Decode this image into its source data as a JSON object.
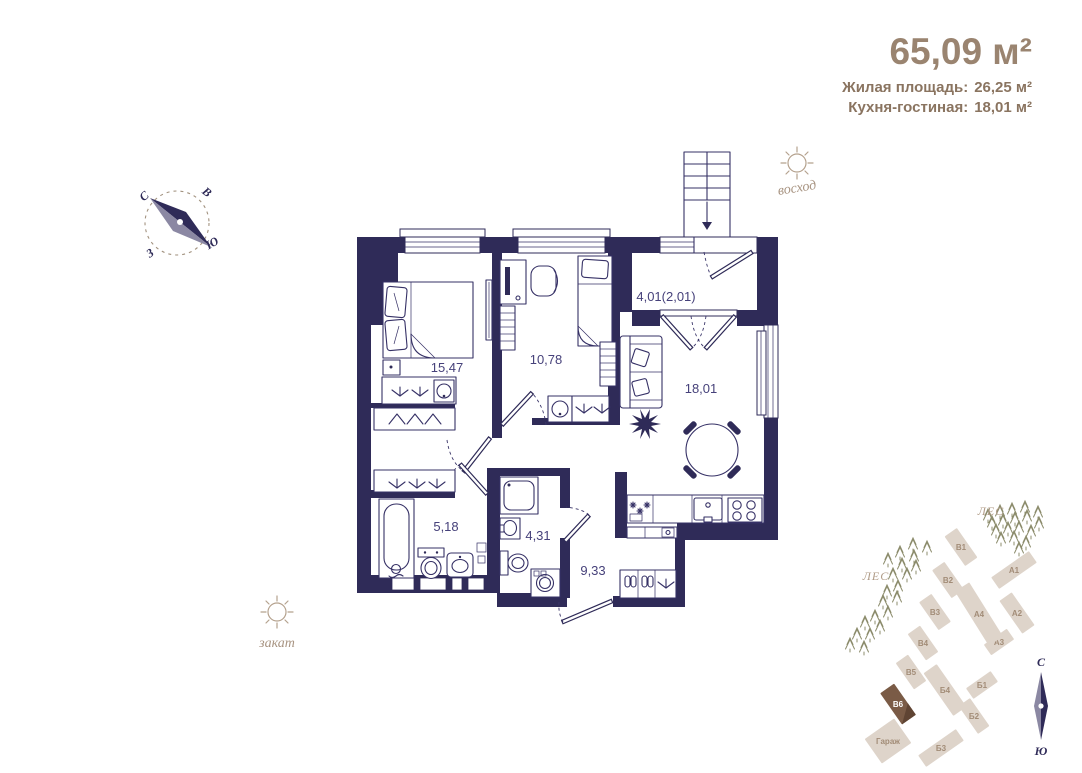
{
  "header": {
    "total_area": "65,09 м²",
    "living": {
      "label": "Жилая площадь:",
      "value": "26,25 м²"
    },
    "kitchen": {
      "label": "Кухня-гостиная:",
      "value": "18,01 м²"
    }
  },
  "orientation": {
    "sunrise": "восход",
    "sunset": "закат",
    "compass": {
      "n": "С",
      "e": "В",
      "s": "Ю",
      "w": "З"
    }
  },
  "rooms": {
    "bedroom": "15,47",
    "child": "10,78",
    "balcony": "4,01(2,01)",
    "living": "18,01",
    "bath": "5,18",
    "wc": "4,31",
    "hall": "9,33"
  },
  "site_plan": {
    "forest1": "ЛЕС",
    "forest2": "ЛЕС",
    "compass": {
      "n": "С",
      "s": "Ю"
    },
    "colors": {
      "building": "#ded4ca",
      "building_label": "#a28c77",
      "selected": "#7a5b46",
      "selected_dark": "#5f4433",
      "selected_label": "#ffffff",
      "tree": "#8c8c6c"
    },
    "buildings": [
      {
        "label": "В1",
        "cx": 961,
        "cy": 547,
        "w": 15,
        "h": 36,
        "rot": -35
      },
      {
        "label": "В2",
        "cx": 948,
        "cy": 580,
        "w": 15,
        "h": 34,
        "rot": -35
      },
      {
        "label": "В3",
        "cx": 935,
        "cy": 612,
        "w": 15,
        "h": 34,
        "rot": -35
      },
      {
        "label": "В4",
        "cx": 923,
        "cy": 643,
        "w": 15,
        "h": 32,
        "rot": -35
      },
      {
        "label": "В5",
        "cx": 911,
        "cy": 672,
        "w": 15,
        "h": 32,
        "rot": -35
      },
      {
        "label": "В6",
        "cx": 898,
        "cy": 704,
        "w": 17,
        "h": 38,
        "rot": -35,
        "selected": true
      },
      {
        "label": "А1",
        "cx": 1014,
        "cy": 570,
        "w": 14,
        "h": 46,
        "rot": 55
      },
      {
        "label": "А2",
        "cx": 1017,
        "cy": 613,
        "w": 15,
        "h": 40,
        "rot": -35
      },
      {
        "label": "А3",
        "cx": 999,
        "cy": 642,
        "w": 13,
        "h": 28,
        "rot": 55
      },
      {
        "label": "А4",
        "cx": 979,
        "cy": 614,
        "w": 17,
        "h": 64,
        "rot": -32
      },
      {
        "label": "Б1",
        "cx": 982,
        "cy": 685,
        "w": 13,
        "h": 30,
        "rot": 55
      },
      {
        "label": "Б2",
        "cx": 974,
        "cy": 716,
        "w": 14,
        "h": 34,
        "rot": -35
      },
      {
        "label": "Б4",
        "cx": 945,
        "cy": 690,
        "w": 16,
        "h": 52,
        "rot": -35
      },
      {
        "label": "Б3",
        "cx": 941,
        "cy": 748,
        "w": 14,
        "h": 46,
        "rot": 55
      },
      {
        "label": "Гараж",
        "cx": 888,
        "cy": 741,
        "w": 36,
        "h": 30,
        "rot": -35,
        "garage": true
      }
    ],
    "trees": [
      [
        988,
        516
      ],
      [
        1000,
        512
      ],
      [
        1012,
        510
      ],
      [
        1025,
        508
      ],
      [
        1038,
        513
      ],
      [
        992,
        523
      ],
      [
        1003,
        521
      ],
      [
        1015,
        519
      ],
      [
        1027,
        517
      ],
      [
        1039,
        524
      ],
      [
        996,
        531
      ],
      [
        1008,
        529
      ],
      [
        1019,
        528
      ],
      [
        1031,
        532
      ],
      [
        1001,
        539
      ],
      [
        1014,
        538
      ],
      [
        1026,
        543
      ],
      [
        1019,
        549
      ],
      [
        913,
        545
      ],
      [
        927,
        548
      ],
      [
        900,
        553
      ],
      [
        914,
        557
      ],
      [
        888,
        560
      ],
      [
        902,
        565
      ],
      [
        916,
        567
      ],
      [
        893,
        575
      ],
      [
        907,
        575
      ],
      [
        898,
        587
      ],
      [
        887,
        592
      ],
      [
        883,
        602
      ],
      [
        897,
        598
      ],
      [
        888,
        613
      ],
      [
        875,
        617
      ],
      [
        865,
        623
      ],
      [
        880,
        627
      ],
      [
        857,
        635
      ],
      [
        870,
        635
      ],
      [
        850,
        645
      ],
      [
        864,
        648
      ]
    ]
  },
  "plan_colors": {
    "wall": "#2f2b58",
    "area_text": "#46417a"
  }
}
